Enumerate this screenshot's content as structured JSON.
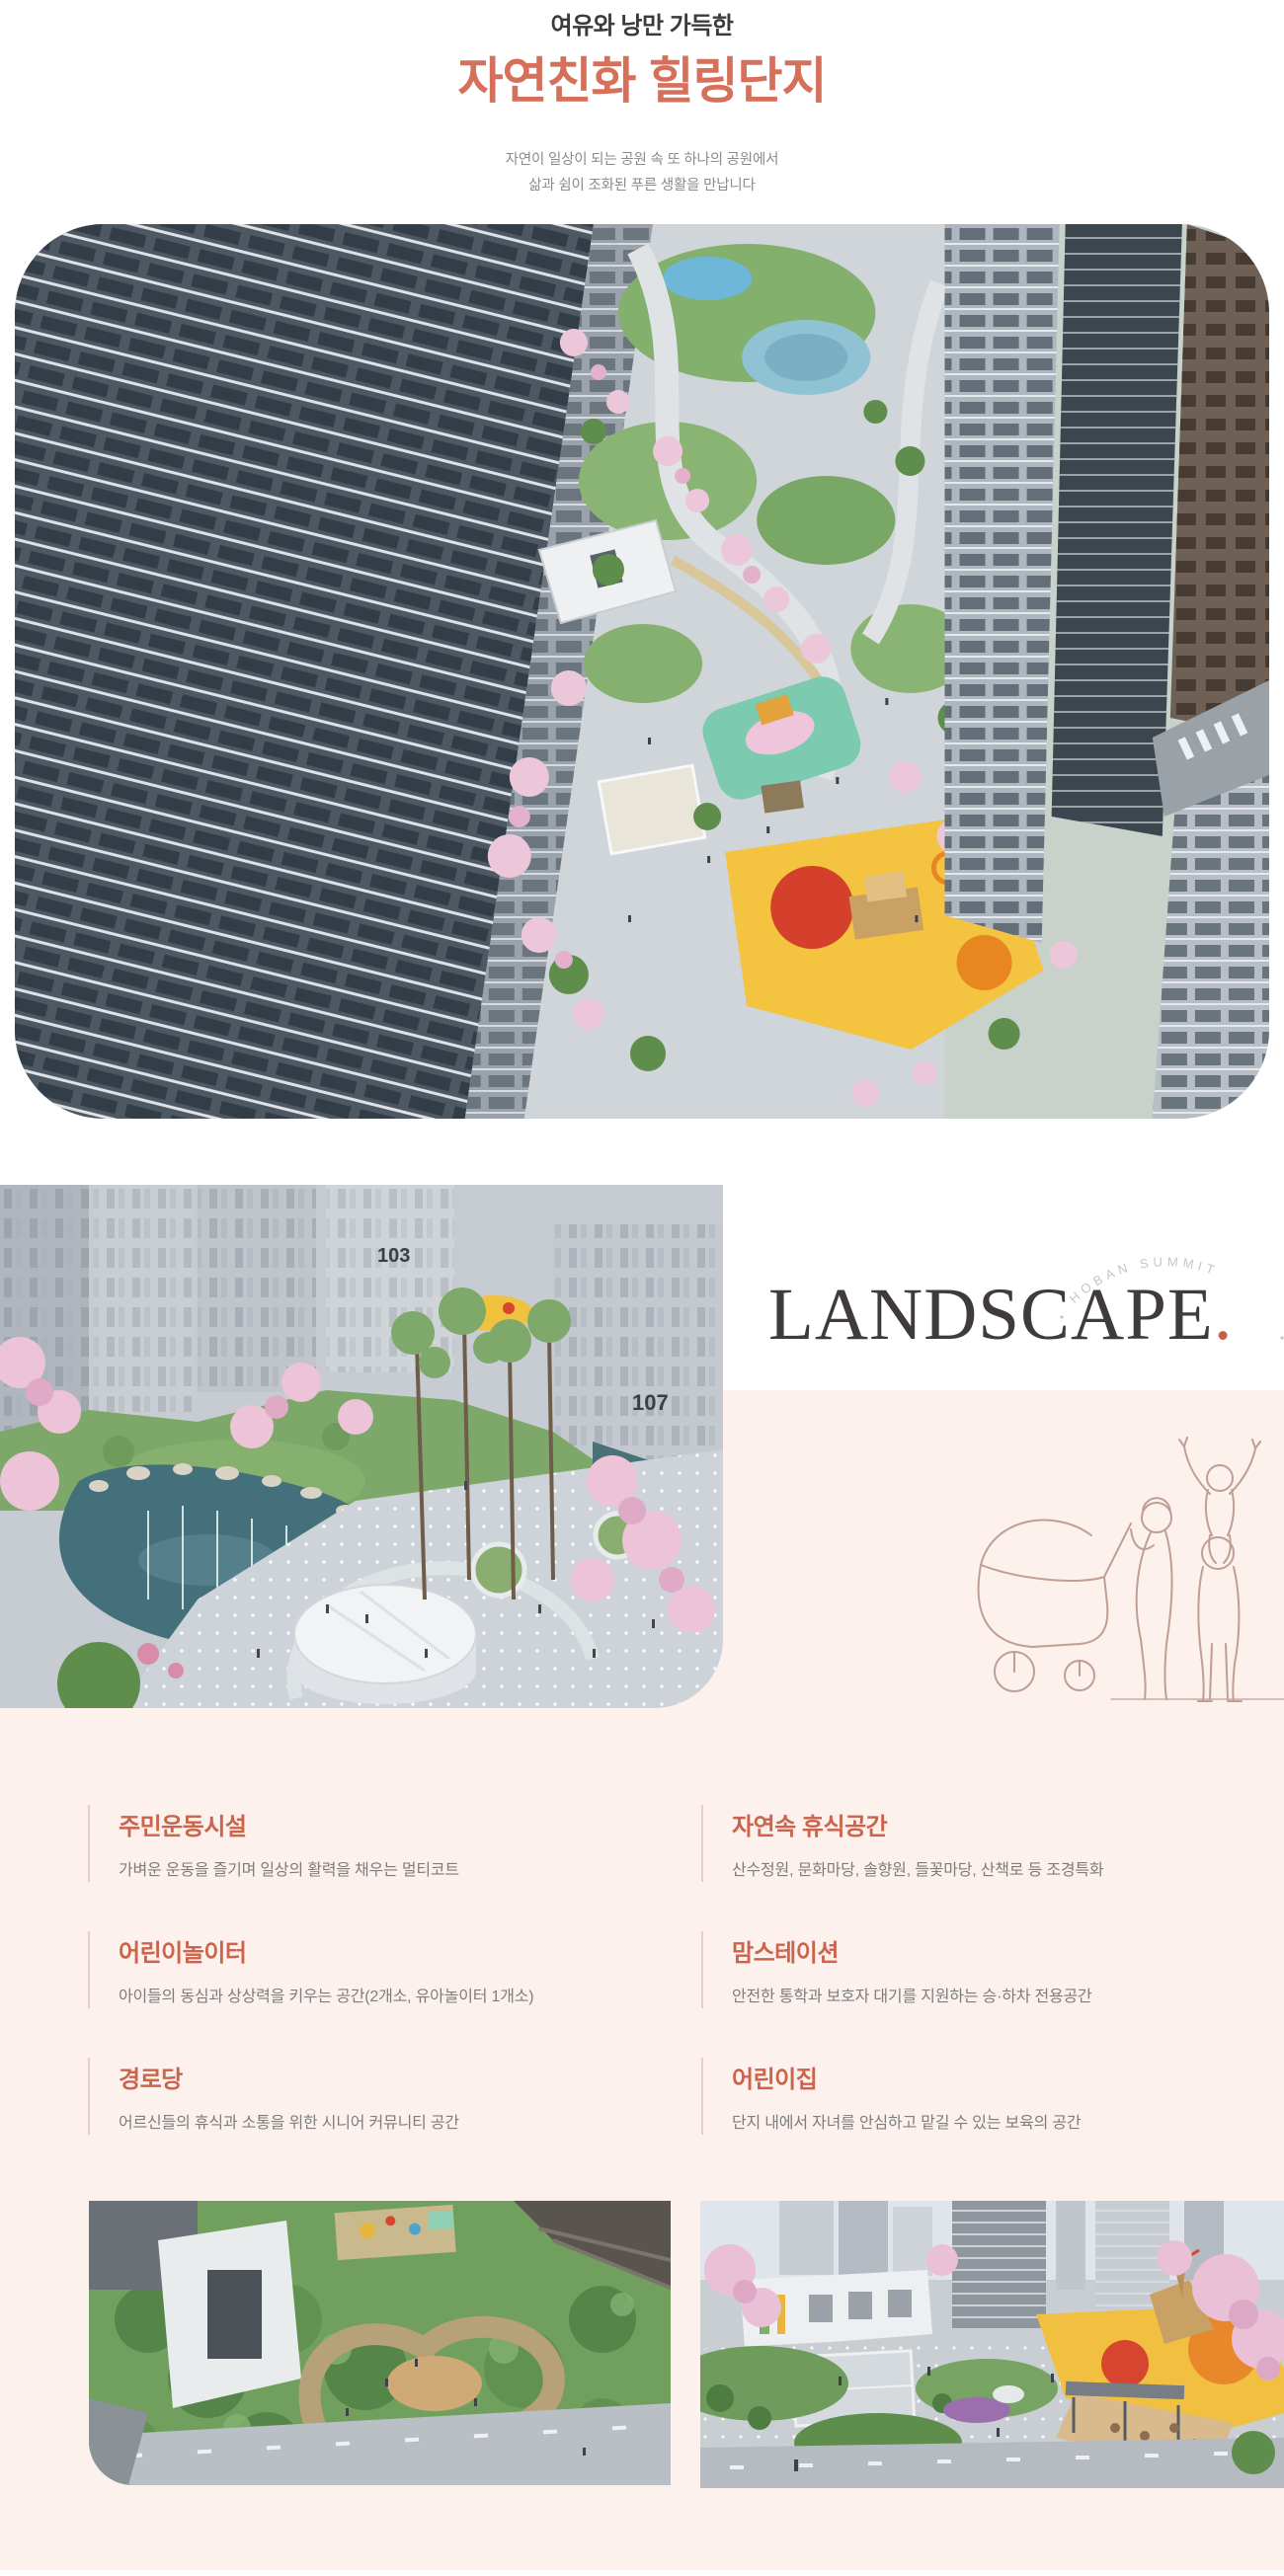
{
  "page": {
    "accent_color": "#d5705b",
    "feature_title_color": "#cb644c",
    "pink_background": "#fcf1ed",
    "landscape_dot_color": "#c75e46",
    "line_art_color": "#bf9f94"
  },
  "header": {
    "eyebrow": "여유와 낭만 가득한",
    "title": "자연친화 힐링단지",
    "subtitle_line1": "자연이 일상이 되는 공원 속 또 하나의 공원에서",
    "subtitle_line2": "삶과 쉼이 조화된 푸른 생활을 만납니다"
  },
  "landscape_section": {
    "title": "LANDSCAPE",
    "title_dot": ".",
    "arc_text": "HOBAN SUMMIT",
    "photo_building_labels": [
      "103",
      "107"
    ]
  },
  "features": {
    "left": [
      {
        "title": "주민운동시설",
        "desc": "가벼운 운동을 즐기며 일상의 활력을 채우는 멀티코트"
      },
      {
        "title": "어린이놀이터",
        "desc": "아이들의 동심과 상상력을 키우는 공간(2개소, 유아놀이터 1개소)"
      },
      {
        "title": "경로당",
        "desc": "어르신들의 휴식과 소통을 위한 시니어 커뮤니티 공간"
      }
    ],
    "right": [
      {
        "title": "자연속 휴식공간",
        "desc": "산수정원, 문화마당, 솔향원, 들꽃마당, 산책로 등 조경특화"
      },
      {
        "title": "맘스테이션",
        "desc": "안전한 통학과 보호자 대기를 지원하는 승·하차 전용공간"
      },
      {
        "title": "어린이집",
        "desc": "단지 내에서 자녀를 안심하고 맡길 수 있는 보육의 공간"
      }
    ]
  }
}
